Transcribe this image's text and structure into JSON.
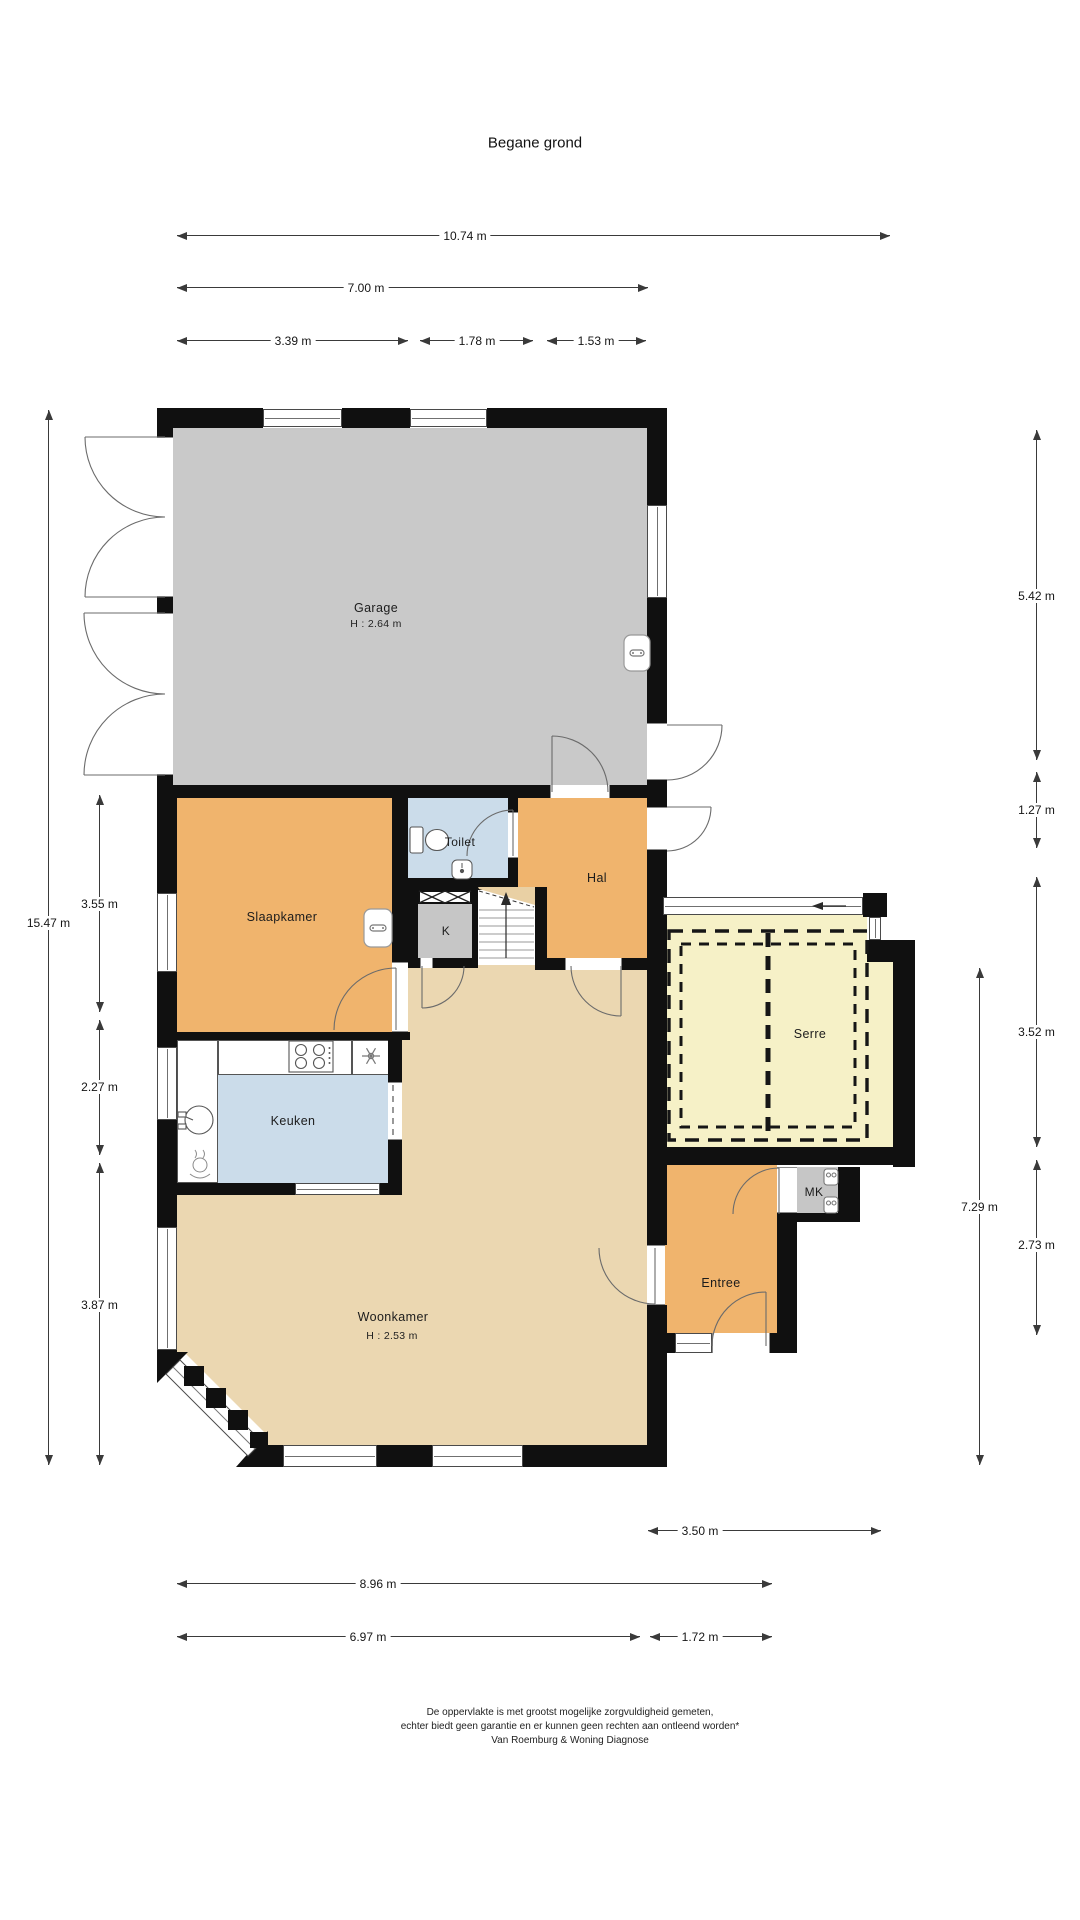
{
  "title": "Begane grond",
  "colors": {
    "wall": "#101010",
    "garage": "#c9c9c9",
    "room_orange": "#f0b46d",
    "room_blue": "#cbdcea",
    "room_tan": "#ebd7b1",
    "room_yellow": "#f6f1c7",
    "closet_gray": "#c6c6c6",
    "stair_wedge": "#e9d0a4",
    "dimension_line": "#3a3a3a"
  },
  "rooms": {
    "garage": {
      "label": "Garage",
      "ceiling": "H : 2.64 m"
    },
    "slaapkamer": {
      "label": "Slaapkamer"
    },
    "toilet": {
      "label": "Toilet"
    },
    "hal": {
      "label": "Hal"
    },
    "kast": {
      "label": "K"
    },
    "serre": {
      "label": "Serre"
    },
    "keuken": {
      "label": "Keuken"
    },
    "woonkamer": {
      "label": "Woonkamer",
      "ceiling": "H : 2.53 m"
    },
    "entree": {
      "label": "Entree"
    },
    "meterkast": {
      "label": "MK"
    }
  },
  "dimensions": {
    "top": [
      {
        "label": "10.74 m"
      },
      {
        "label": "7.00 m"
      },
      {
        "label": "3.39 m"
      },
      {
        "label": "1.78 m"
      },
      {
        "label": "1.53 m"
      }
    ],
    "left": [
      {
        "label": "15.47 m"
      },
      {
        "label": "3.55 m"
      },
      {
        "label": "2.27 m"
      },
      {
        "label": "3.87 m"
      }
    ],
    "right": [
      {
        "label": "5.42 m"
      },
      {
        "label": "1.27 m"
      },
      {
        "label": "3.52 m"
      },
      {
        "label": "7.29 m"
      },
      {
        "label": "2.73 m"
      }
    ],
    "bottom": [
      {
        "label": "3.50 m"
      },
      {
        "label": "8.96 m"
      },
      {
        "label": "6.97 m"
      },
      {
        "label": "1.72 m"
      }
    ]
  },
  "icons": {
    "stairs_direction": "up-arrow",
    "serre_slide_direction": "left-arrow"
  },
  "footer": {
    "line1": "De oppervlakte is met grootst mogelijke zorgvuldigheid gemeten,",
    "line2": "echter biedt geen garantie en er kunnen geen rechten aan ontleend worden*",
    "line3": "Van Roemburg & Woning Diagnose"
  }
}
